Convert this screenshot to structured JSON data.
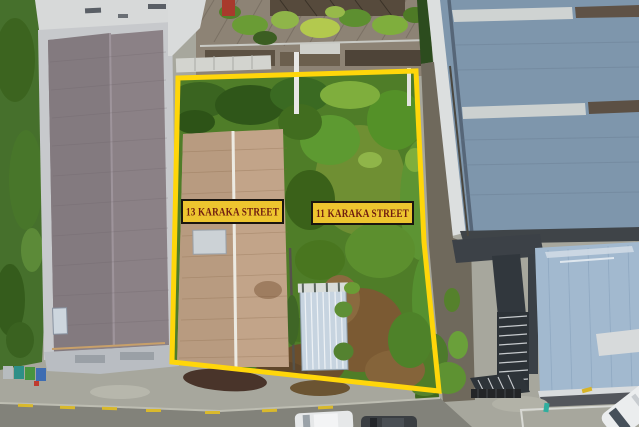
{
  "labels": {
    "lot13": "13 KARAKA STREET",
    "lot11": "11 KARAKA STREET"
  },
  "colors": {
    "boundary": "#FFD60A",
    "label_background": "#EDC52F",
    "label_border": "#1A150F",
    "label_text": "#701D10"
  }
}
